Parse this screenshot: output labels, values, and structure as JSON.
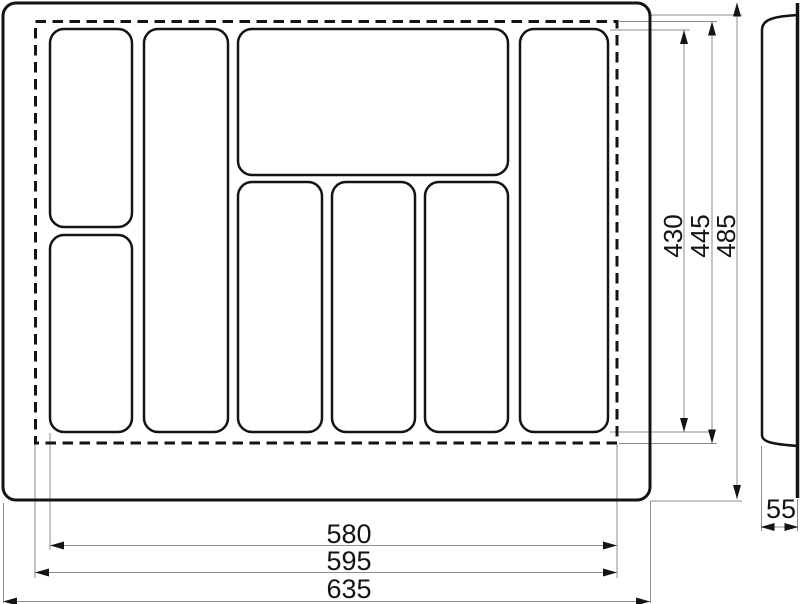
{
  "drawing": {
    "colors": {
      "outline": "#141414",
      "thin_line": "#8c8c8c",
      "background": "#ffffff"
    },
    "labels": {
      "v430": "430",
      "v445": "445",
      "v485": "485",
      "h580": "580",
      "h595": "595",
      "h635": "635",
      "depth55": "55"
    }
  }
}
